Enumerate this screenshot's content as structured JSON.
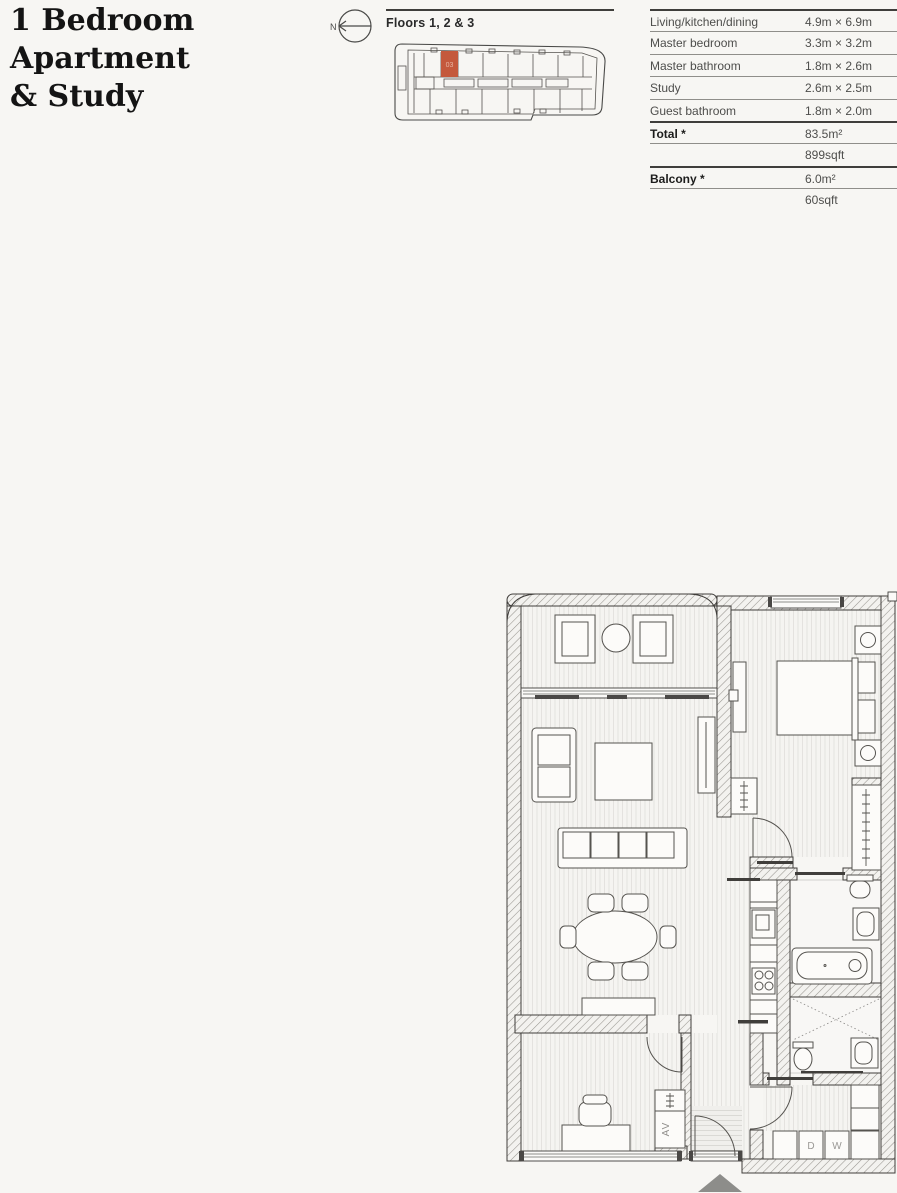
{
  "page": {
    "background": "#f7f6f3"
  },
  "header": {
    "title": "1 Bedroom\nApartment\n& Study",
    "north_label": "N",
    "floors_label": "Floors 1, 2 & 3",
    "building_plan": {
      "highlighted_unit": "03",
      "highlight_color": "#c4593c"
    }
  },
  "spec_table": {
    "rows": [
      {
        "label": "Living/kitchen/dining",
        "value": "4.9m × 6.9m",
        "bold": false,
        "rule": "heavy"
      },
      {
        "label": "Master bedroom",
        "value": "3.3m × 3.2m",
        "bold": false,
        "rule": "light"
      },
      {
        "label": "Master bathroom",
        "value": "1.8m × 2.6m",
        "bold": false,
        "rule": "light"
      },
      {
        "label": "Study",
        "value": "2.6m × 2.5m",
        "bold": false,
        "rule": "light"
      },
      {
        "label": "Guest bathroom",
        "value": "1.8m × 2.0m",
        "bold": false,
        "rule": "light"
      },
      {
        "label": "Total *",
        "value": "83.5m²",
        "bold": true,
        "rule": "heavy"
      },
      {
        "label": "",
        "value": "899sqft",
        "bold": false,
        "rule": "light"
      },
      {
        "label": "Balcony *",
        "value": "6.0m²",
        "bold": true,
        "rule": "heavy"
      },
      {
        "label": "",
        "value": "60sqft",
        "bold": false,
        "rule": "light"
      }
    ]
  },
  "floor_plan": {
    "labels": {
      "av_closet": "AV",
      "dryer": "D",
      "washer": "W"
    },
    "entrance_marker_color": "#8d8d8a"
  }
}
